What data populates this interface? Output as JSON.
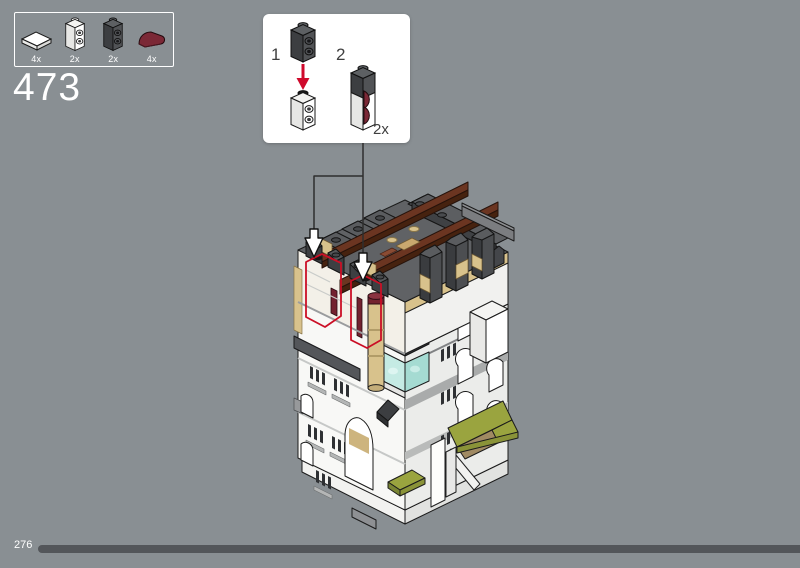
{
  "background_color": "#898f93",
  "step": {
    "number": "473"
  },
  "parts_panel": {
    "items": [
      {
        "icon": "tile-1x2-white-icon",
        "count": "4x",
        "color": "#ffffff"
      },
      {
        "icon": "brick-1x1x2-side-studs-white-icon",
        "count": "2x",
        "color": "#ffffff"
      },
      {
        "icon": "brick-1x1x2-side-studs-dark-gray-icon",
        "count": "2x",
        "color": "#515356"
      },
      {
        "icon": "slope-curved-dark-red-icon",
        "count": "4x",
        "color": "#7b2836"
      }
    ]
  },
  "callout": {
    "sub_steps": [
      {
        "label": "1"
      },
      {
        "label": "2"
      }
    ],
    "quantity": "2x",
    "arrow_color": "#cf0a2c"
  },
  "footer": {
    "page_number": "276"
  },
  "colors": {
    "accent_red": "#cb0f26",
    "brick_dark_gray": "#3f4144",
    "brick_white": "#f8f8f6",
    "brick_tan": "#d8c28c",
    "beam_brown": "#6b3521",
    "brick_olive": "#9aa43f",
    "brick_dark_red": "#73222f",
    "glass_teal": "#bfe7e1",
    "progress_bar": "#53565a"
  }
}
